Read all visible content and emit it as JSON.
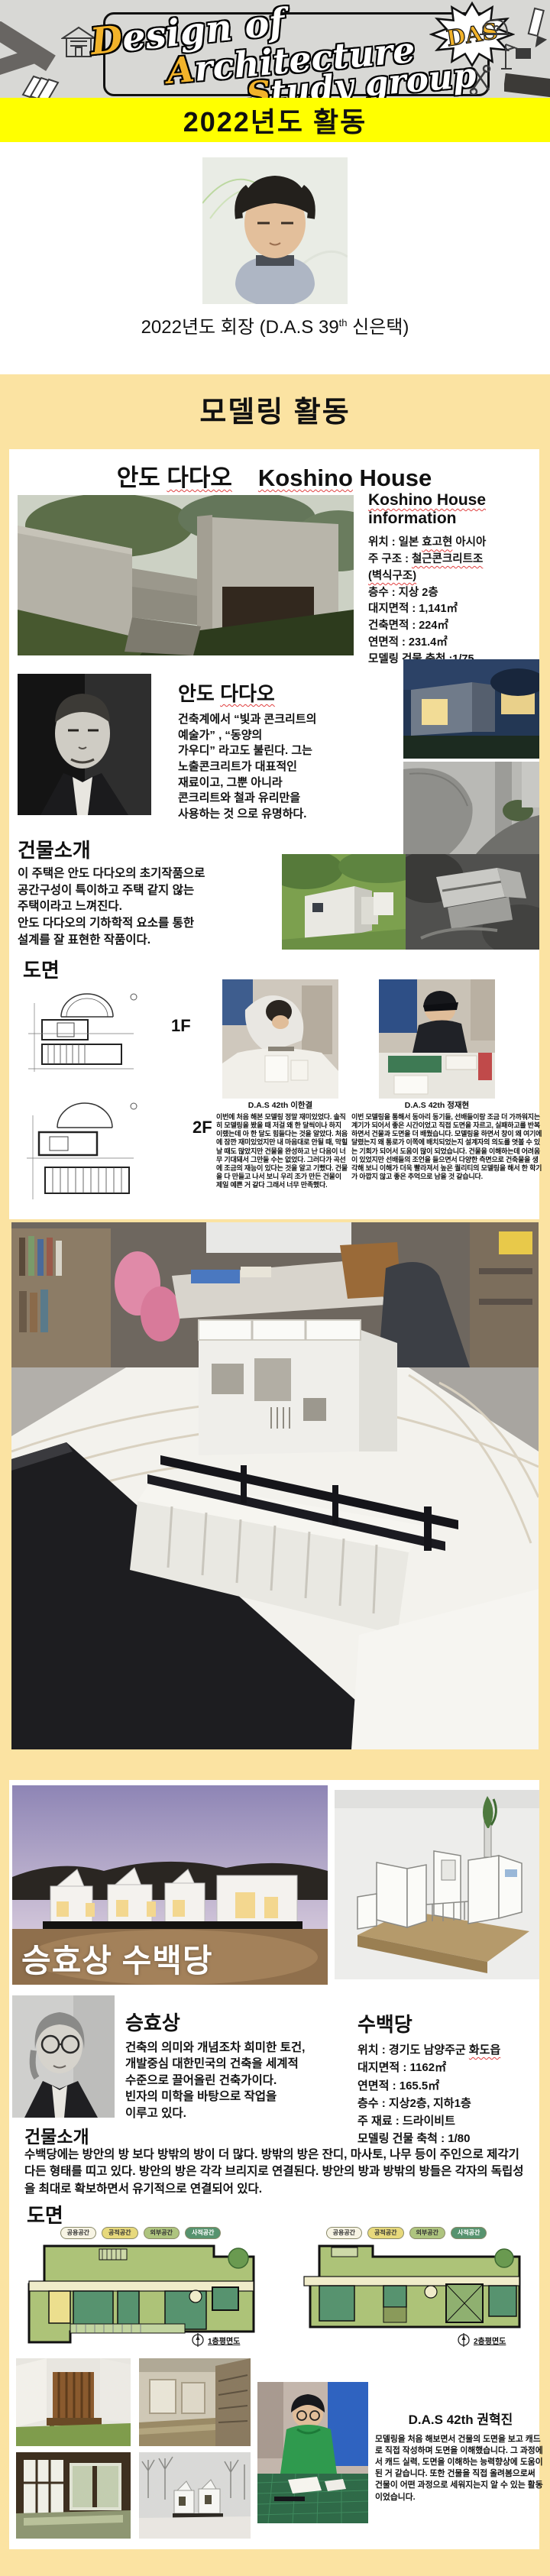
{
  "colors": {
    "banner_yellow": "#ffff00",
    "section_yellow": "#fbe3a2",
    "logo_accent_yellow": "#f2b32a",
    "spellcheck_red": "#e04040"
  },
  "header": {
    "badge": "DAS",
    "logo_lines": [
      {
        "init": "D",
        "rest": "esign of"
      },
      {
        "init": "A",
        "rest": "rchitecture"
      },
      {
        "init": "S",
        "rest": "tudy group"
      }
    ]
  },
  "banner2022": {
    "title": "2022년도 활동"
  },
  "president": {
    "caption_pre": "2022년도 회장 (D.A.S 39",
    "caption_sup": "th",
    "caption_post": " 신은택)"
  },
  "modeling": {
    "title": "모델링 활동"
  },
  "koshino": {
    "title_kr1": "안도 ",
    "title_kr2": "다다오",
    "title_en1": "Koshino",
    "title_en2": " House",
    "info_heading1": "Koshino House",
    "info_heading2": "information",
    "info_lines": [
      {
        "pre": "위치 : 일본 ",
        "wavy": "효고현",
        "post": " 아시아"
      },
      {
        "pre": "주 구조 : ",
        "wavy": "철근콘크리트조",
        "post": ""
      },
      {
        "pre": "",
        "wavy": "(벽식구조)",
        "post": ""
      },
      {
        "pre": "층수 : 지상 2층",
        "wavy": "",
        "post": ""
      },
      {
        "pre": "대지면적 : 1,141㎡",
        "wavy": "",
        "post": ""
      },
      {
        "pre": "건축면적 : 224㎡",
        "wavy": "",
        "post": ""
      },
      {
        "pre": "연면적 : 231.4㎡",
        "wavy": "",
        "post": ""
      },
      {
        "pre": "모델링 건물 축척 :1/75",
        "wavy": "",
        "post": ""
      }
    ],
    "architect_name1": "안도 ",
    "architect_name2": "다다오",
    "architect_bio": "건축계에서 “빛과 콘크리트의\n예술가” , “동양의\n가우디” 라고도 불린다. 그는\n노출콘크리트가 대표적인\n재료이고, 그뿐 아니라\n콘크리트와 철과 유리만을\n사용하는 것 으로 유명하다.",
    "intro_title": "건물소개",
    "intro_body": "이 주택은 안도 다다오의 초기작품으로\n공간구성이 특이하고 주택 같지 않는\n주택이라고 느껴진다.\n안도 다다오의 기하학적 요소를 통한\n설계를 잘 표현한 작품이다.",
    "drawings_title": "도면",
    "floor1_label": "1F",
    "floor2_label": "2F",
    "students": [
      {
        "caption": "D.A.S 42th 이한결",
        "review": "이번에 처음 해본 모델링 정말 재미있었다. 솔직히 모델링을 봤을 때 저걸 왜 한 달씩이나 하지 이랬는데 아 한 달도 힘들다는 것을 알았다. 처음에 잠깐 재미있었지만 내 마음대로 안될 때, 막힐 날 때도 많았지만 건물을 완성하고 난 다음이 너무 기대돼서 그만둘 수는 없었다. 그러다가 곡선에 조금의 재능이 있다는 것을 알고 기뻤다. 건물을 다 만들고 나서 보니 우리 조가 만든 건물이 제일 예쁜 거 같다 그래서 너무 만족했다."
      },
      {
        "caption": "D.A.S 42th 정재현",
        "review": "이번 모델링을 통해서 동아리 동기들, 선배들이랑 조금 더 가까워지는 계기가 되어서 좋은 시간이었고 직접 도면을 자르고, 실패하고를 반복하면서 건물과 도면을 더 배웠습니다. 모델링을 하면서 창이 왜 여기에 달렸는지 왜 통로가 이쪽에 배치되었는지 설계자의 의도를 엿볼 수 있는 기회가 되어서 도움이 많이 되었습니다. 건물을 이해하는데 어려움이 있었지만 선배들의 조언을 들으면서 다양한 측면으로 건축물을 생각해 보니 이해가 더욱 빨라져서 높은 퀄리티의 모델링을 해서 한 학기가 아깝지 않고 좋은 추억으로 남을 것 같습니다."
      }
    ]
  },
  "subaek": {
    "overlay_title": "승효상 수백당",
    "architect_name": "승효상",
    "architect_bio": "건축의 의미와 개념조차 희미한 토건,\n개발중심 대한민국의 건축을 세계적\n수준으로 끌어올린 건축가이다.\n빈자의 미학을 바탕으로 작업을\n이루고 있다.",
    "house_name": "수백당",
    "info_lines": [
      {
        "pre": "위치 : 경기도 남양주군 ",
        "wavy": "화도읍",
        "post": ""
      },
      {
        "pre": "대지면적 : 1162㎡",
        "wavy": "",
        "post": ""
      },
      {
        "pre": "연면적 : 165.5㎡",
        "wavy": "",
        "post": ""
      },
      {
        "pre": "층수 : 지상2층, 지하1층",
        "wavy": "",
        "post": ""
      },
      {
        "pre": "주 재료 : 드라이비트",
        "wavy": "",
        "post": ""
      },
      {
        "pre": "모델링 건물 축척 : 1/80",
        "wavy": "",
        "post": ""
      }
    ],
    "intro_title": "건물소개",
    "intro_body": "수백당에는 방안의 방 보다 방밖의 방이 더 많다. 방밖의 방은 잔디, 마사토, 나무 등이 주인으로 제각기 다든 형태를 띠고 있다. 방안의 방은 각각 브리지로 연결된다. 방안의 방과 방밖의 방들은 각자의 독립성을 최대로 확보하면서 유기적으로 연결되어 있다.",
    "drawings_title": "도면",
    "legend": [
      "공용공간",
      "공적공간",
      "외부공간",
      "사적공간"
    ],
    "plan_captions": [
      "1층평면도",
      "2층평면도"
    ],
    "student": {
      "caption": "D.A.S 42th 권혁진",
      "review": "모델링을 처음 해보면서 건물의 도면을 보고 캐드로 직접 작성하며 도면을 이해했습니다. 그 과정에서 캐드 실력, 도면을 이해하는 능력향상에 도움이 된 거 같습니다. 또한 건물을 직접 올려봄으로써 건물이 어떤 과정으로 세워지는지 알 수 있는 활동이었습니다."
    }
  }
}
